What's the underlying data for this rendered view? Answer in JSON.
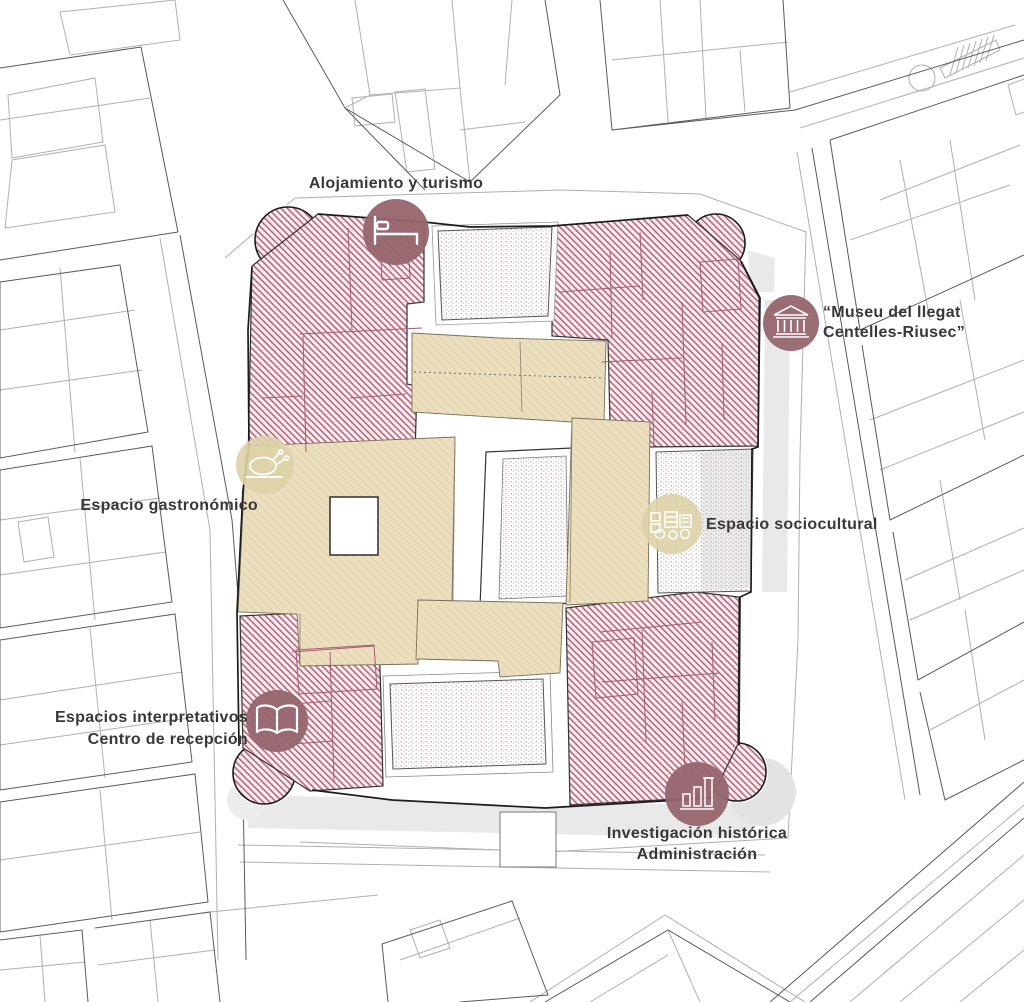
{
  "diagram": {
    "type": "architectural-site-plan",
    "subject": "Castle / palace complex functional zoning plan with surrounding cadastral map",
    "colors": {
      "red_zone_hatch": "#b5647a",
      "red_zone_bg": "#f6ebee",
      "tan_zone": "#ebdfc0",
      "dot_courtyard": "#c4606e",
      "badge_dark": "#96656e",
      "badge_beige": "#ddd2a6",
      "wall_line": "#1c1c1c",
      "context_line": "#b0b0b0",
      "label_text": "#383838"
    },
    "labels": [
      {
        "id": "alojamiento",
        "text": "Alojamiento y turismo",
        "icon": "bed-icon",
        "badge": "dark"
      },
      {
        "id": "museu",
        "line1": "“Museu del llegat",
        "line2": "Centelles-Riusec”",
        "icon": "museum-icon",
        "badge": "dark"
      },
      {
        "id": "gastronomico",
        "text": "Espacio gastronómico",
        "icon": "roast-chicken-icon",
        "badge": "beige"
      },
      {
        "id": "sociocultural",
        "text": "Espacio sociocultural",
        "icon": "carriage-icon",
        "badge": "beige"
      },
      {
        "id": "interpretativos",
        "line1": "Espacios interpretativos",
        "line2": "Centro de recepción",
        "icon": "open-book-icon",
        "badge": "dark"
      },
      {
        "id": "investigacion",
        "line1": "Investigación histórica",
        "line2": "Administración",
        "icon": "ruin-columns-icon",
        "badge": "dark"
      }
    ],
    "zones": [
      {
        "id": "nw-block",
        "style": "red-hatch",
        "label_ref": "alojamiento"
      },
      {
        "id": "ne-block",
        "style": "red-hatch",
        "label_ref": "museu"
      },
      {
        "id": "sw-block",
        "style": "red-hatch",
        "label_ref": "interpretativos"
      },
      {
        "id": "se-block",
        "style": "red-hatch",
        "label_ref": "investigacion"
      },
      {
        "id": "left-wing",
        "style": "tan",
        "label_ref": "gastronomico"
      },
      {
        "id": "right-wing",
        "style": "tan",
        "label_ref": "sociocultural"
      },
      {
        "id": "courtyards",
        "style": "red-dots",
        "count": 4
      }
    ]
  }
}
